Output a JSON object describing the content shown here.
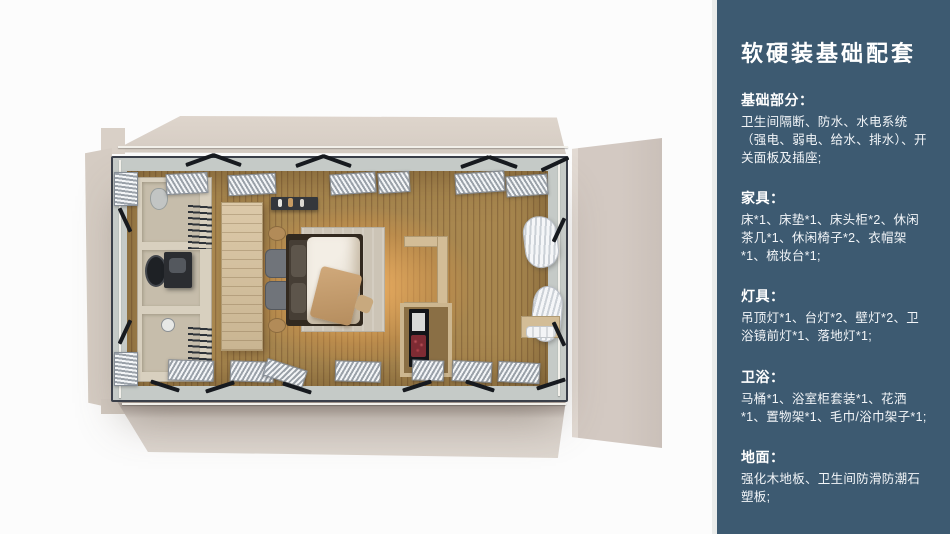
{
  "sidebar": {
    "title": "软硬装基础配套",
    "sections": [
      {
        "heading": "基础部分：",
        "body": "卫生间隔断、防水、水电系统（强电、弱电、给水、排水）、开关面板及插座;"
      },
      {
        "heading": "家具：",
        "body": "床*1、床垫*1、床头柜*2、休闲茶几*1、休闲椅子*2、衣帽架*1、梳妆台*1;"
      },
      {
        "heading": "灯具：",
        "body": "吊顶灯*1、台灯*2、壁灯*2、卫浴镜前灯*1、落地灯*1;"
      },
      {
        "heading": "卫浴：",
        "body": "马桶*1、浴室柜套装*1、花洒*1、置物架*1、毛巾/浴巾架子*1;"
      },
      {
        "heading": "地面：",
        "body": "强化木地板、卫生间防滑防潮石塑板;"
      }
    ]
  },
  "colors": {
    "sidebar_accent": "#3d5a71",
    "flap_beige": "#d6cdc4",
    "frame_dark": "#3a3f49",
    "wood_floor": "#a8874f",
    "floor_glow": "#f0a95c",
    "glass_band": "#c5cac7"
  }
}
